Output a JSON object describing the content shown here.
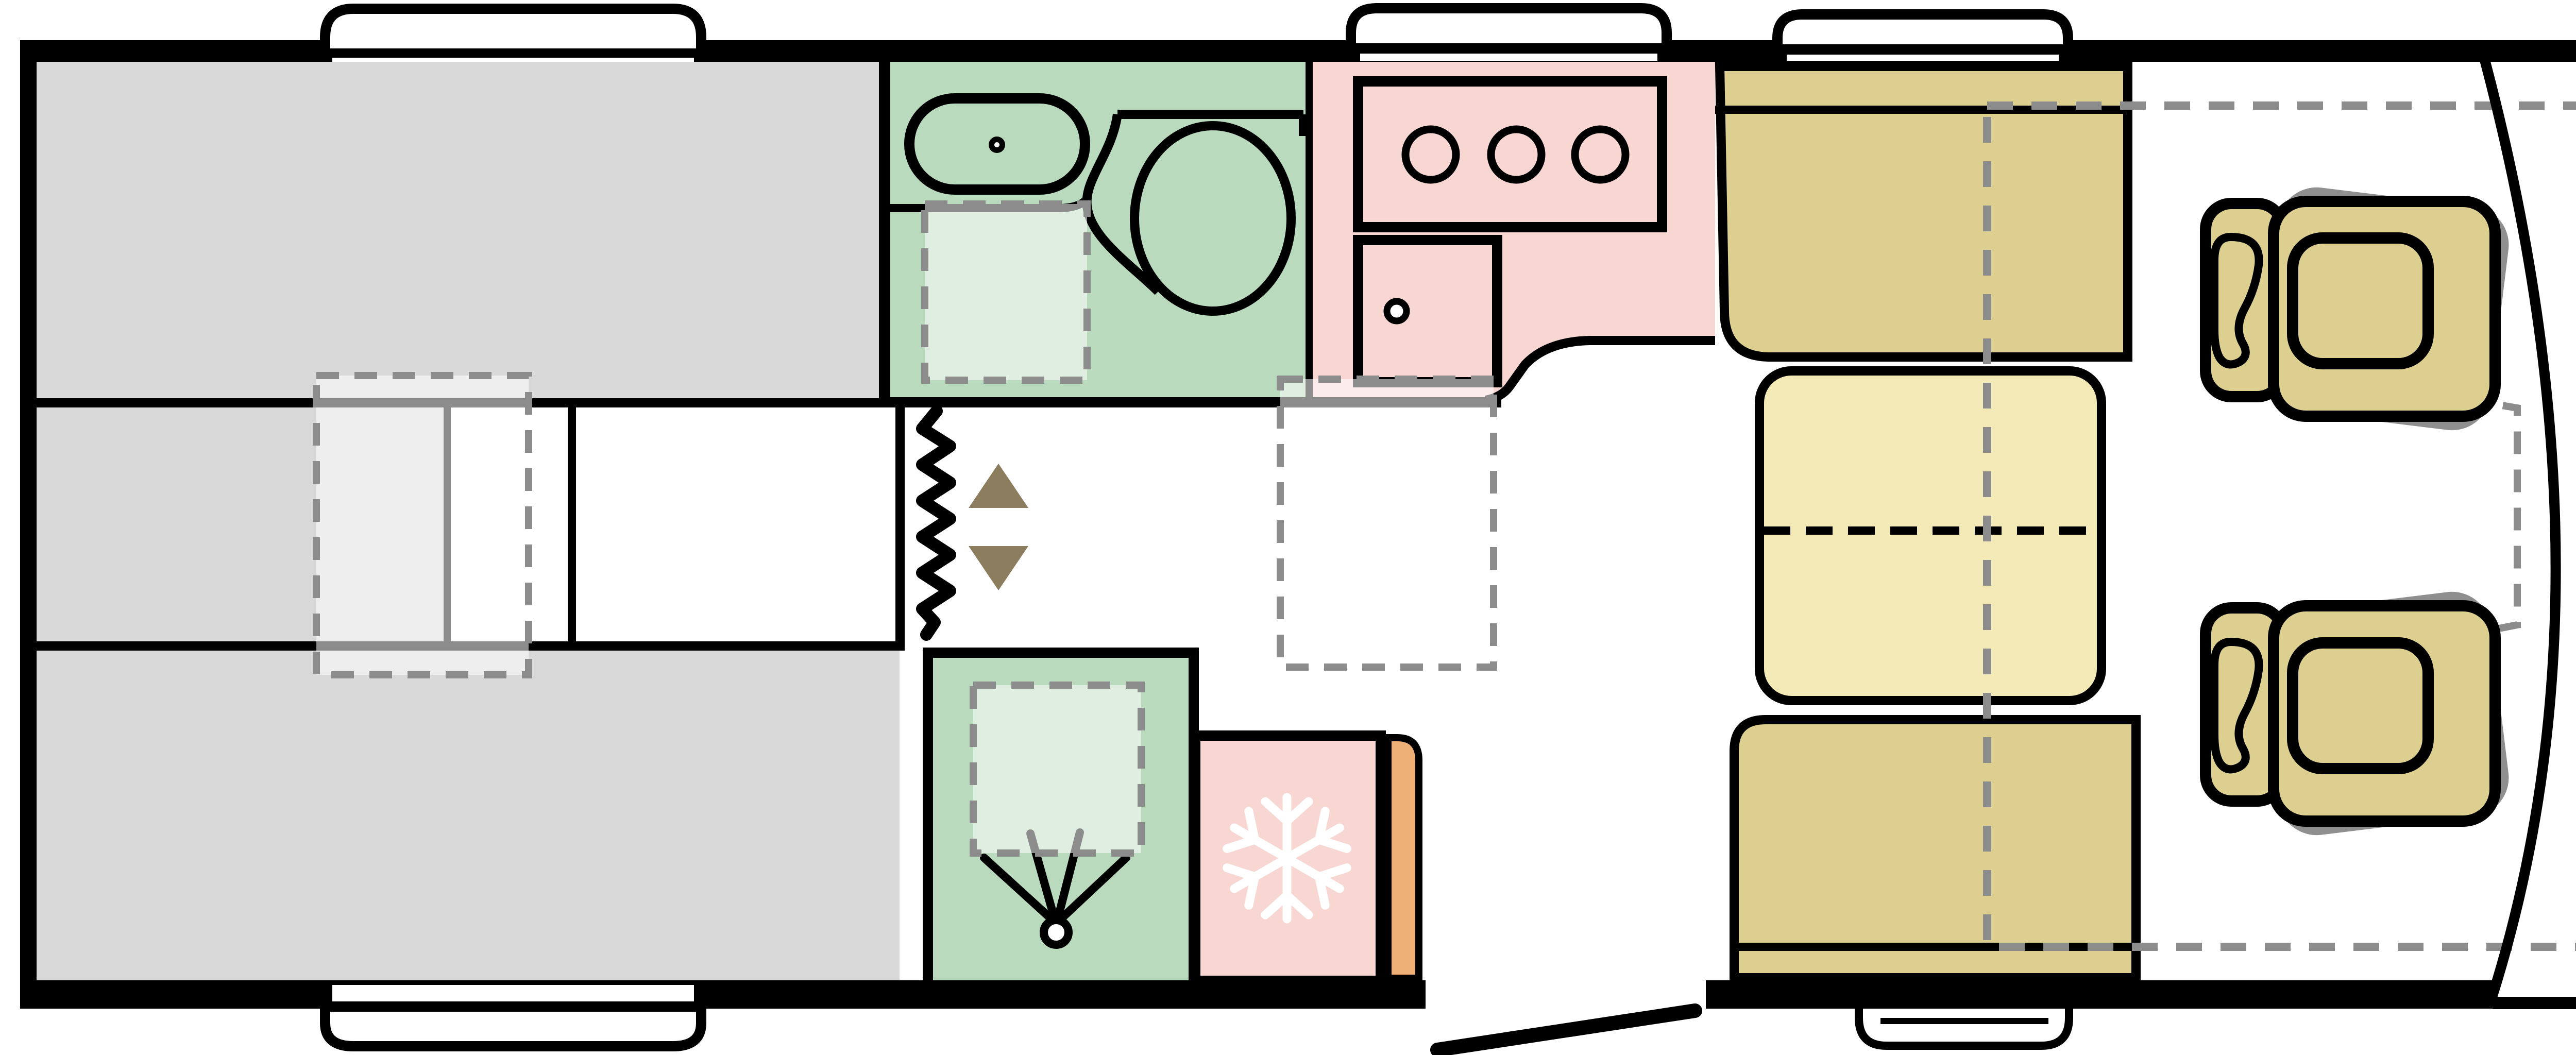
{
  "app": {
    "name": "Motorhome floorplan diagram",
    "type": "top-view vehicle layout",
    "visible_text": []
  },
  "palette": {
    "body": "#ffffff",
    "wall": "#000000",
    "bed_gray": "#d9d9d9",
    "washroom_green": "#b9dabd",
    "kitchen_pink": "#f8d6d2",
    "wood_orange": "#efb077",
    "furniture_tan": "#dccf90",
    "table_yellow": "#f2e9b7",
    "ghost_cream": "#f3ecca",
    "arrow_olive": "#8b7d5d",
    "dash_gray": "#8c8c8c",
    "overlay_white": "rgba(255,255,255,0.55)",
    "icon_white": "#ffffff"
  },
  "areas": [
    {
      "id": "rear-bed",
      "label": "Rear bed area"
    },
    {
      "id": "bed-middle-walkway",
      "label": "Rear walkway between bed sections"
    },
    {
      "id": "washroom",
      "label": "Washroom with basin and toilet"
    },
    {
      "id": "shower-room",
      "label": "Shower room"
    },
    {
      "id": "kitchen",
      "label": "Kitchen with hob and sink"
    },
    {
      "id": "fridge",
      "label": "Fridge"
    },
    {
      "id": "wardrobe",
      "label": "Wardrobe / flexible partition"
    },
    {
      "id": "dinette",
      "label": "Dinette with folding table"
    },
    {
      "id": "cab",
      "label": "Driver cab with two swivel seats"
    },
    {
      "id": "drop-down-bed",
      "label": "Drop-down bed outline"
    },
    {
      "id": "entry-door",
      "label": "Entry door"
    },
    {
      "id": "entry-step",
      "label": "Entry step"
    },
    {
      "id": "roof-vents",
      "label": "Roof vents"
    }
  ],
  "icons": [
    {
      "name": "hob-burners-icon",
      "meaning": "3-ring gas hob"
    },
    {
      "name": "kitchen-sink-icon",
      "meaning": "kitchen sink with tap"
    },
    {
      "name": "basin-icon",
      "meaning": "washroom basin with tap"
    },
    {
      "name": "toilet-icon",
      "meaning": "toilet"
    },
    {
      "name": "shower-spray-icon",
      "meaning": "shower head"
    },
    {
      "name": "snowflake-icon",
      "meaning": "refrigerator"
    },
    {
      "name": "zigzag-partition-icon",
      "meaning": "concertina wardrobe door"
    },
    {
      "name": "up-down-arrows-icon",
      "meaning": "drop-down bed direction"
    },
    {
      "name": "cab-seat-icon",
      "meaning": "swivel cab seat"
    },
    {
      "name": "door-swing-icon",
      "meaning": "open entry door"
    }
  ]
}
